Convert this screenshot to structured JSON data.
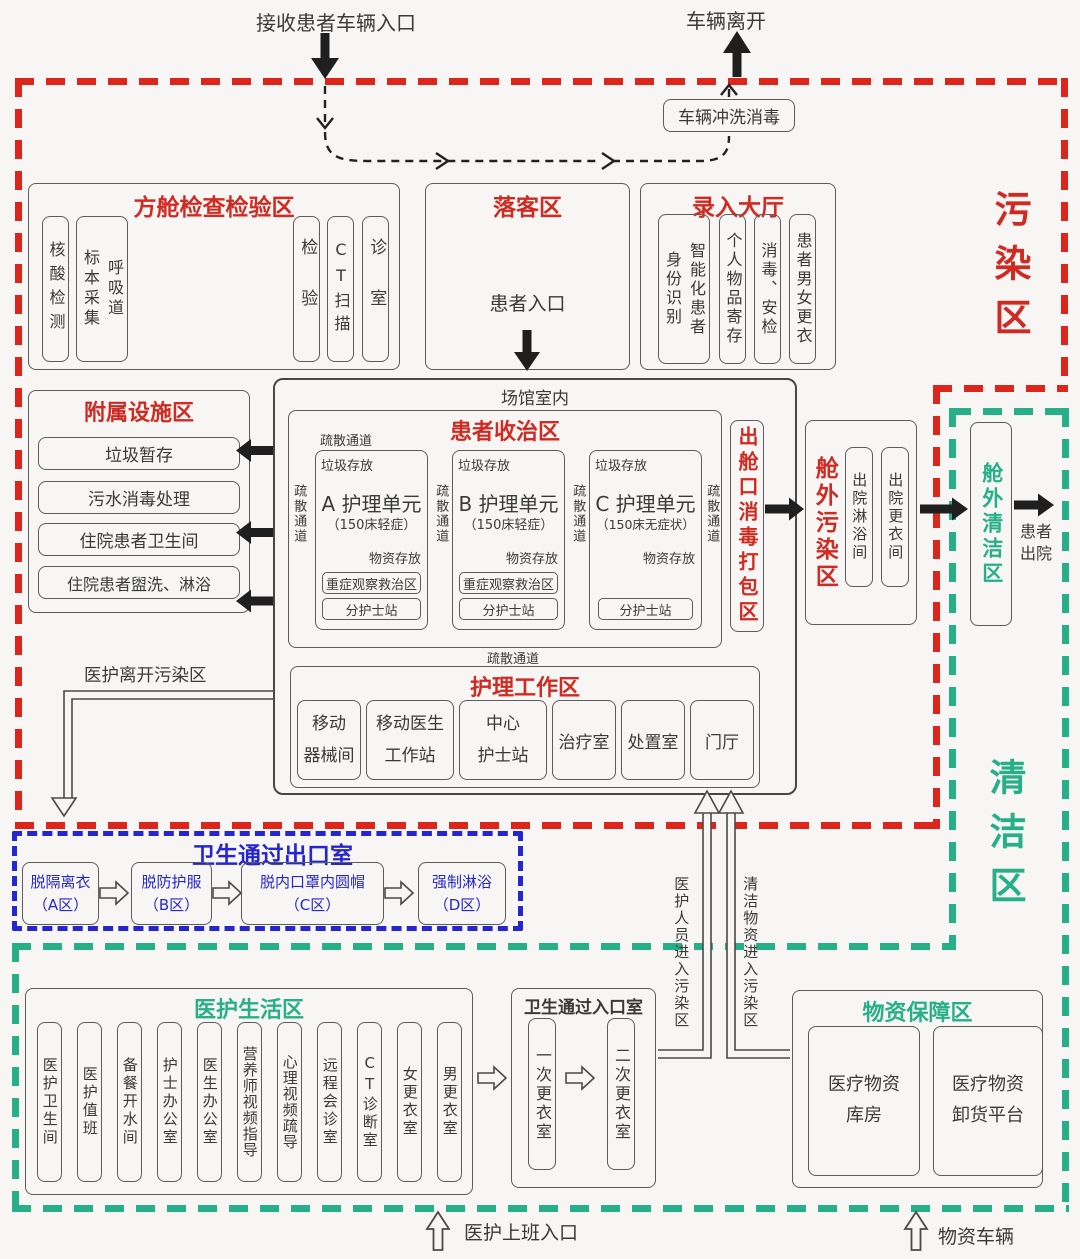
{
  "colors": {
    "contaminated_red": "#cf2b22",
    "clean_green": "#27b087",
    "exit_blue": "#2626cf",
    "ink": "#3a3a3a"
  },
  "zones": {
    "contaminated": "污染区",
    "clean": "清洁区"
  },
  "top": {
    "entry": "接收患者车辆入口",
    "leave": "车辆离开",
    "wash": "车辆冲洗消毒"
  },
  "exam": {
    "title": "方舱检查检验区",
    "items": [
      "核酸检测",
      "呼吸道\n标本采集",
      "检验",
      "CT扫描",
      "诊室"
    ]
  },
  "drop": {
    "title": "落客区",
    "entrance": "患者入口"
  },
  "intake": {
    "title": "录入大厅",
    "items": [
      "智能化患者\n身份识别",
      "个人物品寄存",
      "消毒、安检",
      "患者男女更衣"
    ]
  },
  "aux": {
    "title": "附属设施区",
    "items": [
      "垃圾暂存",
      "污水消毒处理",
      "住院患者卫生间",
      "住院患者盥洗、淋浴"
    ]
  },
  "venue": {
    "label": "场馆室内"
  },
  "treat": {
    "title": "患者收治区",
    "corridor": "疏散通道",
    "units": [
      {
        "trash": "垃圾存放",
        "name": "A 护理单元",
        "cap": "（150床轻症）",
        "supply": "物资存放",
        "obs": "重症观察救治区",
        "nurse": "分护士站"
      },
      {
        "trash": "垃圾存放",
        "name": "B 护理单元",
        "cap": "（150床轻症）",
        "supply": "物资存放",
        "obs": "重症观察救治区",
        "nurse": "分护士站"
      },
      {
        "trash": "垃圾存放",
        "name": "C 护理单元",
        "cap": "（150床无症状）",
        "supply": "物资存放",
        "nurse": "分护士站"
      }
    ]
  },
  "nursing": {
    "title": "护理工作区",
    "items": [
      "移动\n器械间",
      "移动医生\n工作站",
      "中心\n护士站",
      "治疗室",
      "处置室",
      "门厅"
    ]
  },
  "discharge": {
    "pack": "出舱口消毒打包区",
    "dirty": {
      "title": "舱外污染区",
      "items": [
        "出院淋浴间",
        "出院更衣间"
      ]
    },
    "clean": "舱外清洁区",
    "out": "患者\n出院"
  },
  "exit_room": {
    "title": "卫生通过出口室",
    "leave": "医护离开污染区",
    "steps": [
      "脱隔离衣\n（A区）",
      "脱防护服\n（B区）",
      "脱内口罩内圆帽\n（C区）",
      "强制淋浴\n（D区）"
    ]
  },
  "corridors": {
    "staff": "医护人员进入污染区",
    "supply": "清洁物资进入污染区"
  },
  "entry_room": {
    "title": "卫生通过入口室",
    "steps": [
      "一次更衣室",
      "二次更衣室"
    ]
  },
  "staff_area": {
    "title": "医护生活区",
    "items": [
      "医护卫生间",
      "医护值班",
      "备餐开水间",
      "护士办公室",
      "医生办公室",
      "营养师视频指导",
      "心理视频疏导",
      "远程会诊室",
      "CT诊断室",
      "女更衣室",
      "男更衣室"
    ]
  },
  "logistics": {
    "title": "物资保障区",
    "items": [
      "医疗物资\n库房",
      "医疗物资\n卸货平台"
    ]
  },
  "bottom": {
    "staff_entry": "医护上班入口",
    "vehicle": "物资车辆"
  }
}
